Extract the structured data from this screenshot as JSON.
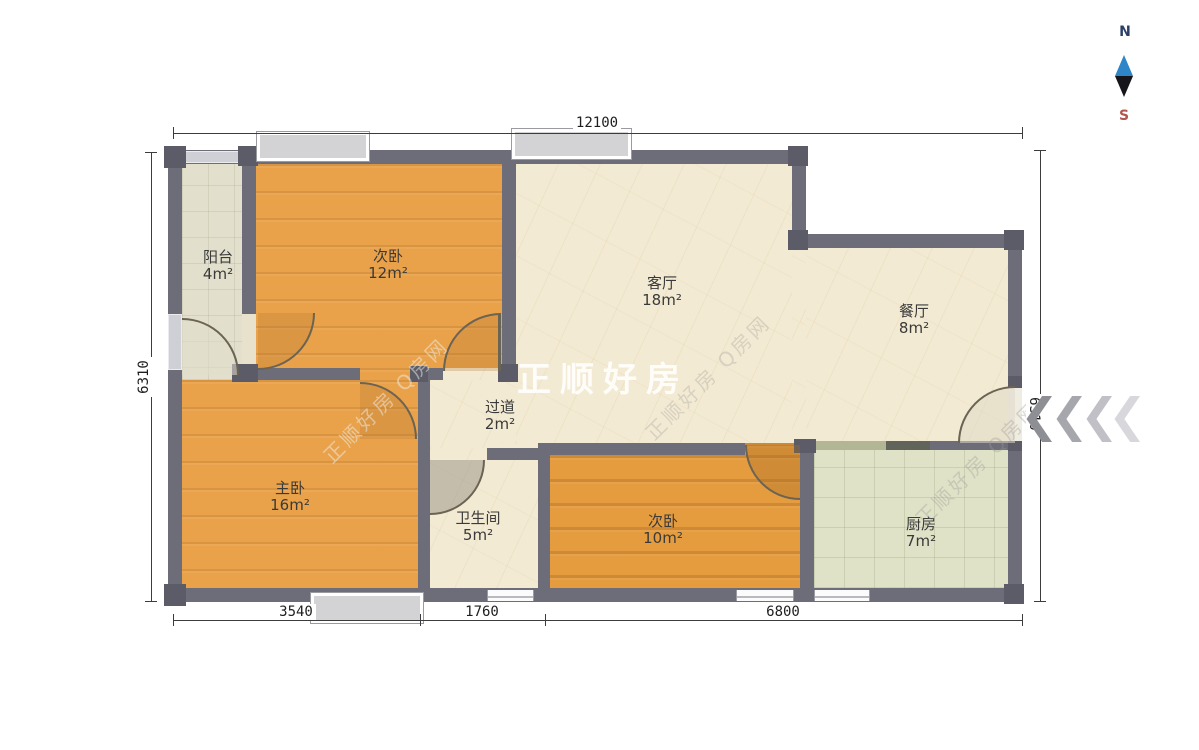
{
  "plan": {
    "rooms": [
      {
        "id": "balcony",
        "label": "阳台",
        "area": "4m²"
      },
      {
        "id": "bedroom-second-a",
        "label": "次卧",
        "area": "12m²"
      },
      {
        "id": "living-room",
        "label": "客厅",
        "area": "18m²"
      },
      {
        "id": "dining-room",
        "label": "餐厅",
        "area": "8m²"
      },
      {
        "id": "hallway",
        "label": "过道",
        "area": "2m²"
      },
      {
        "id": "master-bedroom",
        "label": "主卧",
        "area": "16m²"
      },
      {
        "id": "bathroom",
        "label": "卫生间",
        "area": "5m²"
      },
      {
        "id": "bedroom-second-b",
        "label": "次卧",
        "area": "10m²"
      },
      {
        "id": "kitchen",
        "label": "厨房",
        "area": "7m²"
      }
    ]
  },
  "dimensions": {
    "top": "12100",
    "left": "6310",
    "right": "6310",
    "bottom_segments": [
      "3540",
      "1760",
      "6800"
    ]
  },
  "compass": {
    "north_label": "N",
    "south_label": "S"
  },
  "watermarks": {
    "center": "正顺好房",
    "diagonal": "正顺好房 Q房网"
  },
  "colors": {
    "wall": "#6d6d79",
    "wood_floor": "#e9a24a",
    "marble_floor": "#f3ead3",
    "balcony_tile": "#e2dfcc",
    "kitchen_tile": "#dfe2c6",
    "window_fill": "#d3d3d6",
    "compass_north_text": "#2c3e66",
    "compass_south_text": "#b5544c",
    "needle_top": "#2e86c8",
    "needle_bottom": "#15151a",
    "entry_chevrons": [
      "#8e8e95",
      "#a6a6ad",
      "#c0c0c6",
      "#d8d8dc"
    ]
  }
}
